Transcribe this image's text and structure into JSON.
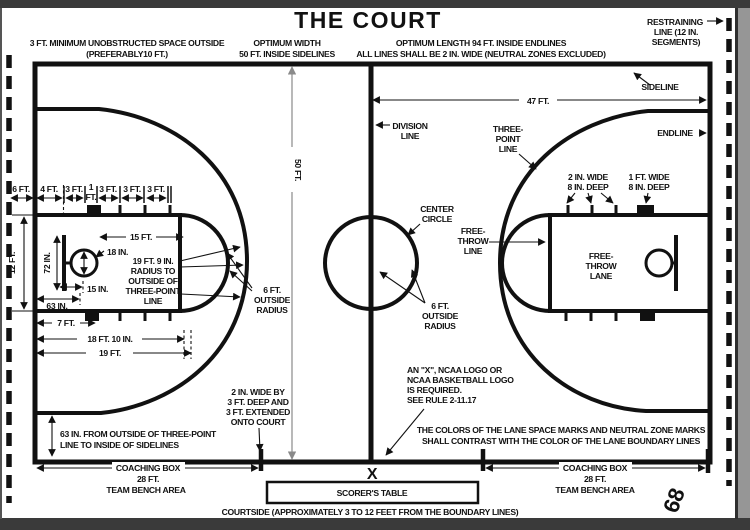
{
  "title": "THE COURT",
  "page_number": "68",
  "colors": {
    "ink": "#111111",
    "dim_gray": "#8a8a8a",
    "page_bg": "#ffffff",
    "mat_bg": "#9e9e9e",
    "frame": "#3a3a3a"
  },
  "notes": {
    "unobstructed": [
      "3 FT. MINIMUM UNOBSTRUCTED SPACE OUTSIDE",
      "(PREFERABLY10 FT.)"
    ],
    "optimum_width": [
      "OPTIMUM WIDTH",
      "50 FT. INSIDE SIDELINES"
    ],
    "optimum_length": [
      "OPTIMUM LENGTH 94 FT. INSIDE ENDLINES",
      "ALL LINES SHALL BE 2 IN. WIDE (NEUTRAL ZONES EXCLUDED)"
    ],
    "restraining": [
      "RESTRAINING",
      "LINE (12 IN.",
      "SEGMENTS)"
    ],
    "ncaa": [
      "AN \"X\", NCAA LOGO OR",
      "NCAA BASKETBALL LOGO",
      "IS REQUIRED.",
      "SEE RULE 2-11.17"
    ],
    "colors_note": [
      "THE COLORS OF THE LANE SPACE MARKS AND NEUTRAL ZONE MARKS",
      "SHALL CONTRAST WITH THE COLOR OF THE LANE BOUNDARY LINES"
    ],
    "sixtythree_outside": [
      "63 IN. FROM OUTSIDE OF THREE-POINT",
      "LINE TO INSIDE OF SIDELINES"
    ],
    "two_in_wide": [
      "2 IN. WIDE BY",
      "3 FT. DEEP AND",
      "3 FT. EXTENDED",
      "ONTO COURT"
    ],
    "courtside": "COURTSIDE (APPROXIMATELY 3 TO 12 FEET FROM THE BOUNDARY LINES)"
  },
  "labels": {
    "sideline": "SIDELINE",
    "endline": "ENDLINE",
    "division_line": [
      "DIVISION",
      "LINE"
    ],
    "three_point_line": [
      "THREE-",
      "POINT",
      "LINE"
    ],
    "center_circle": [
      "CENTER",
      "CIRCLE"
    ],
    "free_throw_line": [
      "FREE-",
      "THROW",
      "LINE"
    ],
    "free_throw_lane": [
      "FREE-",
      "THROW",
      "LANE"
    ],
    "six_ft_outside_radius": [
      "6 FT.",
      "OUTSIDE",
      "RADIUS"
    ],
    "radius_19_9": [
      "19 FT. 9 IN.",
      "RADIUS TO",
      "OUTSIDE OF",
      "THREE-POINT",
      "LINE"
    ],
    "marks_small": [
      "2 IN. WIDE",
      "8 IN. DEEP"
    ],
    "marks_large": [
      "1 FT. WIDE",
      "8 IN. DEEP"
    ]
  },
  "dims": {
    "d47": "47 FT.",
    "d50": "50 FT.",
    "d6": "6 FT.",
    "d4": "4 FT.",
    "d3": "3 FT.",
    "d1a": "1",
    "d1b": "FT.",
    "d12": "12 FT.",
    "d72": "72 IN.",
    "d15ft": "15 FT.",
    "d18in": "18 IN.",
    "d15in": "15 IN.",
    "d63in": "63 IN.",
    "d7": "7 FT.",
    "d18_10": "18 FT. 10 IN.",
    "d19": "19 FT."
  },
  "bottom": {
    "coaching_box": "COACHING BOX",
    "box_length": "28 FT.",
    "bench": "TEAM BENCH AREA",
    "scorers_table": "SCORER'S TABLE",
    "x_mark": "X"
  }
}
